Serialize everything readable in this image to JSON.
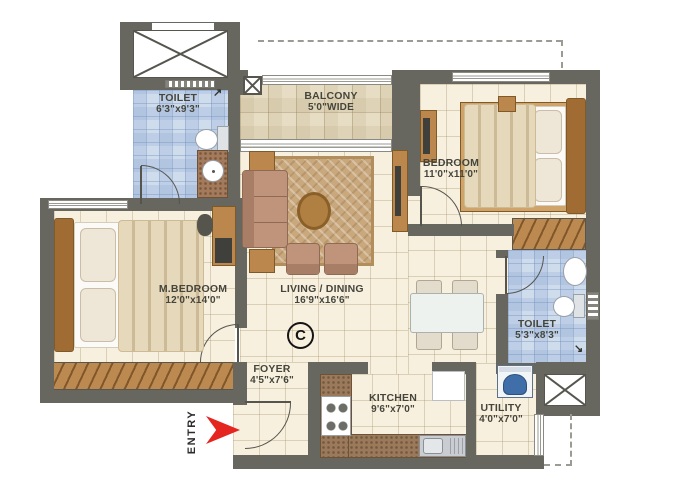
{
  "rooms": {
    "toilet_top": {
      "name": "TOILET",
      "dims": "6'3\"x9'3\""
    },
    "balcony": {
      "name": "BALCONY",
      "dims": "5'0\"WIDE"
    },
    "bedroom": {
      "name": "BEDROOM",
      "dims": "11'0\"x11'0\""
    },
    "master_bedroom": {
      "name": "M.BEDROOM",
      "dims": "12'0\"x14'0\""
    },
    "living_dining": {
      "name": "LIVING / DINING",
      "dims": "16'9\"x16'6\""
    },
    "toilet_right": {
      "name": "TOILET",
      "dims": "5'3\"x8'3\""
    },
    "foyer": {
      "name": "FOYER",
      "dims": "4'5\"x7'6\""
    },
    "kitchen": {
      "name": "KITCHEN",
      "dims": "9'6\"x7'0\""
    },
    "utility": {
      "name": "UTILITY",
      "dims": "4'0\"x7'0\""
    }
  },
  "entry": {
    "label": "ENTRY"
  },
  "copyright": "C",
  "icons": {
    "shower_arrow_ne": "↗",
    "shower_arrow_se": "↘"
  },
  "colors": {
    "wall": "#67675f",
    "floor_tile": "#f8f0df",
    "toilet_tile": "#cedcec",
    "balcony_tile": "#e7ddc5",
    "wood": "#bb874c",
    "entry_arrow_red": "#e52620"
  }
}
